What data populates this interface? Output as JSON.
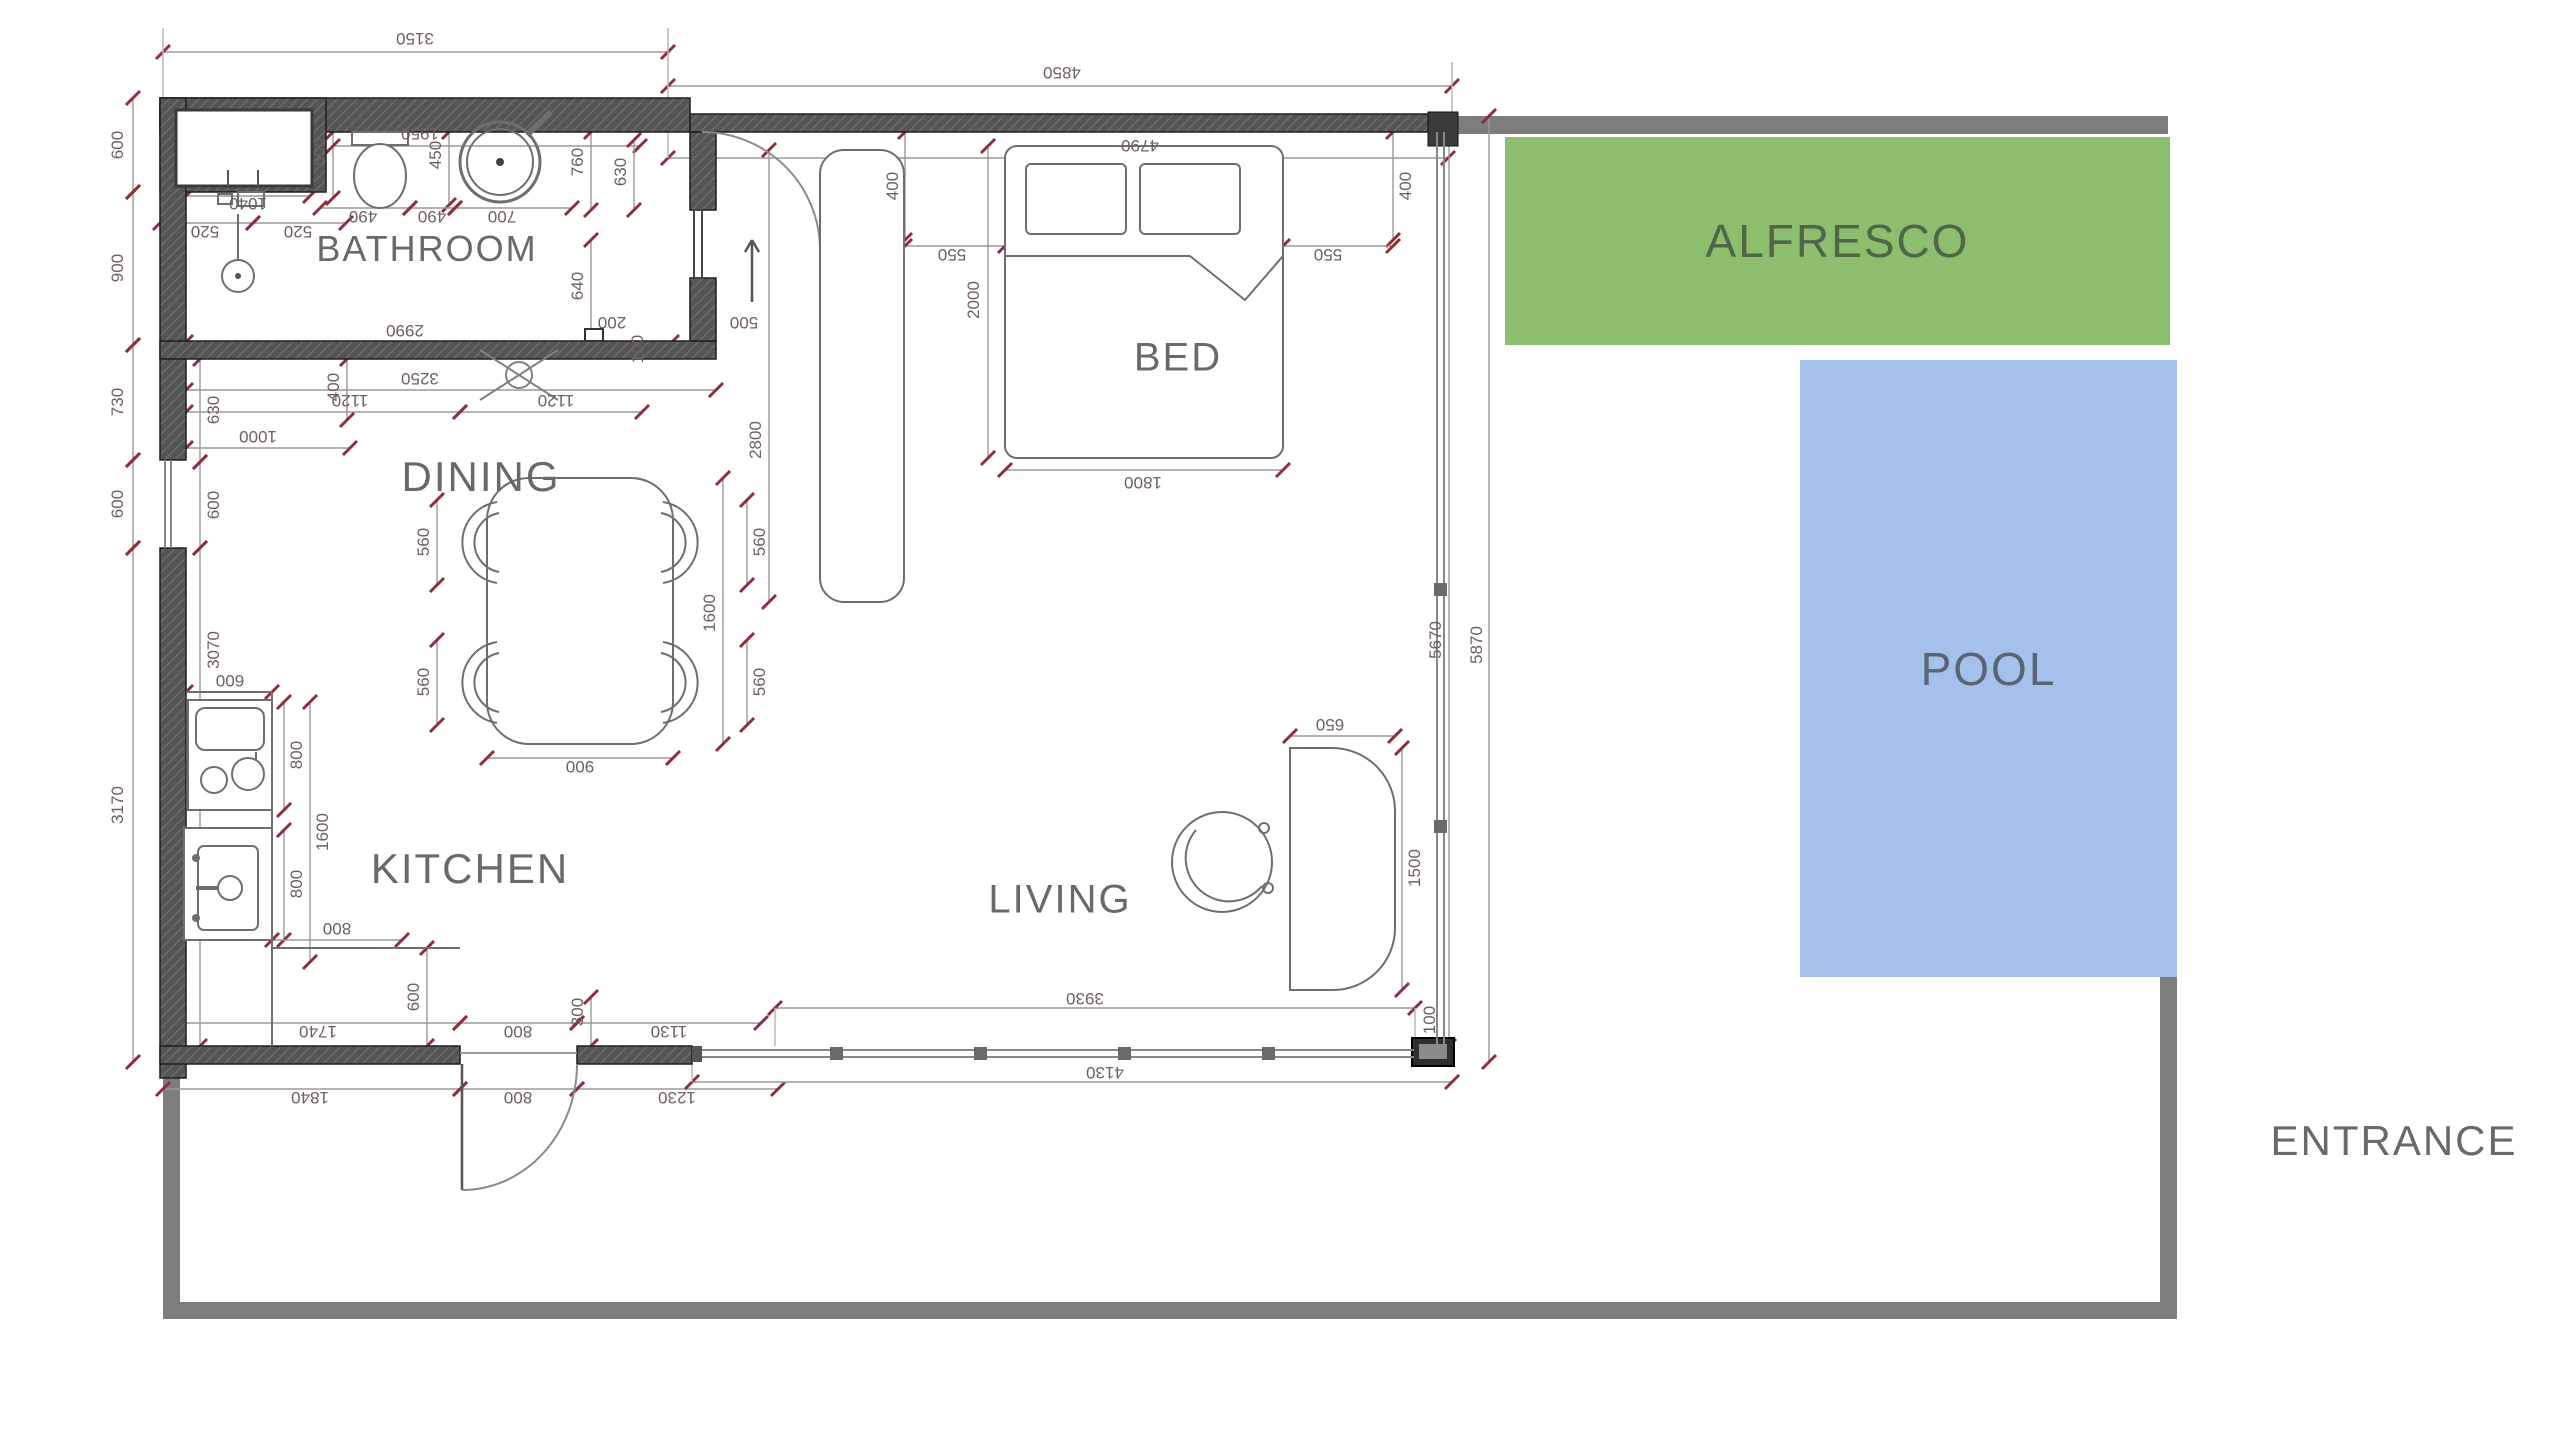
{
  "rooms": {
    "bathroom": "BATHROOM",
    "dining": "DINING",
    "kitchen": "KITCHEN",
    "bed": "BED",
    "living": "LIVING"
  },
  "outdoor": {
    "alfresco": "ALFRESCO",
    "pool": "POOL",
    "entrance": "ENTRANCE"
  },
  "colors": {
    "alfresco_fill": "#8cbe6e",
    "alfresco_text": "#4e6847",
    "pool_fill": "#a4c1ec",
    "pool_text": "#5a6573",
    "boundary_gray": "#7d7d7d",
    "wall_dark": "#555555",
    "dim_text": "#6f5f5f",
    "dim_tick_red": "#8f2d38",
    "label_gray": "#696969"
  },
  "icons": {
    "north_arrow": "up-arrow-icon",
    "door_swing": "door-swing-arc",
    "window_cross": "window-cross-symbol"
  },
  "dimensions": [
    {
      "label": "3150",
      "x": 415,
      "y": 38,
      "rot": 180,
      "line": [
        163,
        52,
        668,
        52
      ]
    },
    {
      "label": "4850",
      "x": 1062,
      "y": 72,
      "rot": 180,
      "line": [
        668,
        86,
        1452,
        86
      ]
    },
    {
      "label": "600",
      "x": 118,
      "y": 145,
      "rot": -90,
      "line": [
        133,
        98,
        133,
        192
      ]
    },
    {
      "label": "900",
      "x": 118,
      "y": 268,
      "rot": -90,
      "line": [
        133,
        192,
        133,
        345
      ]
    },
    {
      "label": "730",
      "x": 118,
      "y": 402,
      "rot": -90,
      "line": [
        133,
        345,
        133,
        460
      ]
    },
    {
      "label": "600",
      "x": 118,
      "y": 504,
      "rot": -90,
      "line": [
        133,
        460,
        133,
        548
      ]
    },
    {
      "label": "3170",
      "x": 118,
      "y": 805,
      "rot": -90,
      "line": [
        133,
        548,
        133,
        1062
      ]
    },
    {
      "label": "630",
      "x": 214,
      "y": 410,
      "rot": -90,
      "line": [
        200,
        359,
        200,
        462
      ]
    },
    {
      "label": "600",
      "x": 214,
      "y": 505,
      "rot": -90,
      "line": [
        200,
        462,
        200,
        548
      ]
    },
    {
      "label": "3070",
      "x": 214,
      "y": 650,
      "rot": -90,
      "line": [
        200,
        548,
        200,
        1046
      ]
    },
    {
      "label": "1040",
      "x": 248,
      "y": 203,
      "rot": 180,
      "line": [
        186,
        196,
        310,
        196
      ]
    },
    {
      "label": "520",
      "x": 205,
      "y": 231,
      "rot": 180,
      "line": [
        160,
        223,
        253,
        223
      ]
    },
    {
      "label": "520",
      "x": 298,
      "y": 231,
      "rot": 180,
      "line": [
        253,
        223,
        346,
        223
      ]
    },
    {
      "label": "500",
      "x": 320,
      "y": 152,
      "rot": -90,
      "line": [
        333,
        132,
        333,
        198
      ]
    },
    {
      "label": "1950",
      "x": 420,
      "y": 133,
      "rot": 180,
      "line": [
        333,
        146,
        640,
        146
      ]
    },
    {
      "label": "450",
      "x": 436,
      "y": 155,
      "rot": -90,
      "line": [
        449,
        132,
        449,
        205
      ]
    },
    {
      "label": "490",
      "x": 363,
      "y": 216,
      "rot": 180,
      "line": [
        320,
        208,
        410,
        208
      ]
    },
    {
      "label": "490",
      "x": 432,
      "y": 216,
      "rot": 180,
      "line": [
        410,
        208,
        455,
        208
      ]
    },
    {
      "label": "700",
      "x": 502,
      "y": 216,
      "rot": 180,
      "line": [
        455,
        208,
        572,
        208
      ]
    },
    {
      "label": "760",
      "x": 578,
      "y": 162,
      "rot": -90,
      "line": [
        591,
        132,
        591,
        210
      ]
    },
    {
      "label": "630",
      "x": 621,
      "y": 172,
      "rot": -90,
      "line": [
        634,
        140,
        634,
        210
      ]
    },
    {
      "label": "640",
      "x": 578,
      "y": 286,
      "rot": -90,
      "line": [
        591,
        240,
        591,
        341
      ]
    },
    {
      "label": "2990",
      "x": 405,
      "y": 330,
      "rot": 180,
      "line": [
        186,
        342,
        672,
        342
      ]
    },
    {
      "label": "200",
      "x": 612,
      "y": 322,
      "rot": 180
    },
    {
      "label": "100",
      "x": 638,
      "y": 349,
      "rot": -90
    },
    {
      "label": "3250",
      "x": 420,
      "y": 378,
      "rot": 180,
      "line": [
        186,
        390,
        716,
        390
      ]
    },
    {
      "label": "1120",
      "x": 350,
      "y": 400,
      "rot": 180,
      "line": [
        186,
        412,
        460,
        412
      ]
    },
    {
      "label": "1120",
      "x": 556,
      "y": 400,
      "rot": 180,
      "line": [
        460,
        412,
        642,
        412
      ]
    },
    {
      "label": "400",
      "x": 334,
      "y": 387,
      "rot": -90,
      "line": [
        347,
        359,
        347,
        420
      ]
    },
    {
      "label": "1000",
      "x": 258,
      "y": 436,
      "rot": 180,
      "line": [
        186,
        448,
        350,
        448
      ]
    },
    {
      "label": "4790",
      "x": 1140,
      "y": 145,
      "rot": 180,
      "line": [
        668,
        158,
        1448,
        158
      ]
    },
    {
      "label": "400",
      "x": 893,
      "y": 186,
      "rot": -90,
      "line": [
        905,
        132,
        905,
        240
      ]
    },
    {
      "label": "550",
      "x": 952,
      "y": 254,
      "rot": 180,
      "line": [
        905,
        246,
        1005,
        246
      ]
    },
    {
      "label": "400",
      "x": 1406,
      "y": 186,
      "rot": -90,
      "line": [
        1393,
        132,
        1393,
        240
      ]
    },
    {
      "label": "550",
      "x": 1328,
      "y": 254,
      "rot": 180,
      "line": [
        1283,
        246,
        1393,
        246
      ]
    },
    {
      "label": "2000",
      "x": 974,
      "y": 300,
      "rot": -90,
      "line": [
        988,
        146,
        988,
        458
      ]
    },
    {
      "label": "1800",
      "x": 1143,
      "y": 482,
      "rot": 180,
      "line": [
        1005,
        470,
        1283,
        470
      ]
    },
    {
      "label": "500",
      "x": 744,
      "y": 322,
      "rot": 180
    },
    {
      "label": "2800",
      "x": 756,
      "y": 440,
      "rot": -90,
      "line": [
        769,
        150,
        769,
        602
      ]
    },
    {
      "label": "560",
      "x": 424,
      "y": 542,
      "rot": -90,
      "line": [
        437,
        500,
        437,
        585
      ]
    },
    {
      "label": "560",
      "x": 424,
      "y": 682,
      "rot": -90,
      "line": [
        437,
        640,
        437,
        725
      ]
    },
    {
      "label": "560",
      "x": 760,
      "y": 542,
      "rot": -90,
      "line": [
        747,
        500,
        747,
        585
      ]
    },
    {
      "label": "560",
      "x": 760,
      "y": 682,
      "rot": -90,
      "line": [
        747,
        640,
        747,
        725
      ]
    },
    {
      "label": "1600",
      "x": 710,
      "y": 613,
      "rot": -90,
      "line": [
        723,
        478,
        723,
        744
      ]
    },
    {
      "label": "900",
      "x": 580,
      "y": 766,
      "rot": 180,
      "line": [
        487,
        758,
        673,
        758
      ]
    },
    {
      "label": "600",
      "x": 230,
      "y": 680,
      "rot": 180,
      "line": [
        186,
        692,
        272,
        692
      ]
    },
    {
      "label": "800",
      "x": 297,
      "y": 755,
      "rot": -90,
      "line": [
        284,
        702,
        284,
        810
      ]
    },
    {
      "label": "1600",
      "x": 323,
      "y": 832,
      "rot": -90,
      "line": [
        310,
        702,
        310,
        962
      ]
    },
    {
      "label": "800",
      "x": 297,
      "y": 884,
      "rot": -90,
      "line": [
        284,
        830,
        284,
        940
      ]
    },
    {
      "label": "800",
      "x": 337,
      "y": 928,
      "rot": 180,
      "line": [
        272,
        940,
        402,
        940
      ]
    },
    {
      "label": "600",
      "x": 414,
      "y": 997,
      "rot": -90,
      "line": [
        427,
        948,
        427,
        1046
      ]
    },
    {
      "label": "300",
      "x": 578,
      "y": 1012,
      "rot": -90,
      "line": [
        591,
        997,
        591,
        1046
      ]
    },
    {
      "label": "1740",
      "x": 318,
      "y": 1031,
      "rot": 180,
      "line": [
        176,
        1023,
        460,
        1023
      ]
    },
    {
      "label": "800",
      "x": 518,
      "y": 1031,
      "rot": 180,
      "line": [
        460,
        1023,
        577,
        1023
      ]
    },
    {
      "label": "1130",
      "x": 669,
      "y": 1031,
      "rot": 180,
      "line": [
        577,
        1023,
        761,
        1023
      ]
    },
    {
      "label": "1840",
      "x": 310,
      "y": 1097,
      "rot": 180,
      "line": [
        163,
        1089,
        460,
        1089
      ]
    },
    {
      "label": "800",
      "x": 518,
      "y": 1097,
      "rot": 180,
      "line": [
        460,
        1089,
        577,
        1089
      ]
    },
    {
      "label": "1230",
      "x": 677,
      "y": 1097,
      "rot": 180,
      "line": [
        577,
        1089,
        778,
        1089
      ]
    },
    {
      "label": "3930",
      "x": 1085,
      "y": 998,
      "rot": 180,
      "line": [
        775,
        1008,
        1415,
        1008
      ]
    },
    {
      "label": "4130",
      "x": 1105,
      "y": 1072,
      "rot": 180,
      "line": [
        692,
        1082,
        1452,
        1082
      ]
    },
    {
      "label": "100",
      "x": 1430,
      "y": 1020,
      "rot": -90
    },
    {
      "label": "650",
      "x": 1330,
      "y": 724,
      "rot": 180,
      "line": [
        1290,
        736,
        1395,
        736
      ]
    },
    {
      "label": "1500",
      "x": 1415,
      "y": 868,
      "rot": -90,
      "line": [
        1402,
        748,
        1402,
        990
      ]
    },
    {
      "label": "5670",
      "x": 1436,
      "y": 640,
      "rot": -90,
      "line": [
        1449,
        132,
        1449,
        1046
      ]
    },
    {
      "label": "5870",
      "x": 1477,
      "y": 645,
      "rot": -90,
      "line": [
        1489,
        116,
        1489,
        1062
      ]
    }
  ]
}
